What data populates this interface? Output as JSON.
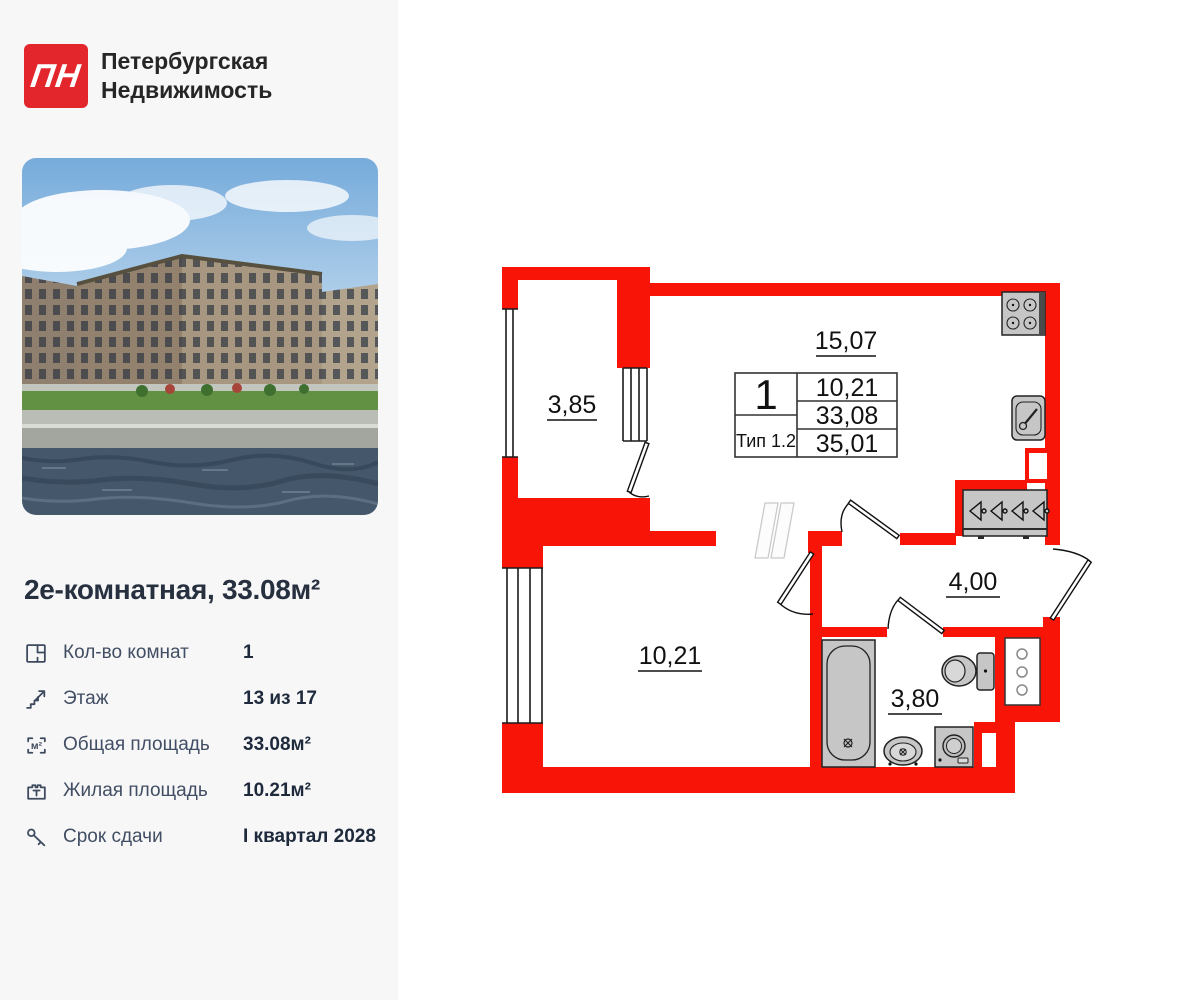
{
  "brand": {
    "logo": "ПН",
    "name_line1": "Петербургская",
    "name_line2": "Недвижимость"
  },
  "listing": {
    "title": "2е-комнатная, 33.08м²"
  },
  "details": [
    {
      "icon": "rooms-icon",
      "label": "Кол-во комнат",
      "value": "1"
    },
    {
      "icon": "floor-icon",
      "label": "Этаж",
      "value": "13 из 17"
    },
    {
      "icon": "total-area-icon",
      "label": "Общая площадь",
      "value": "33.08м²"
    },
    {
      "icon": "living-area-icon",
      "label": "Жилая площадь",
      "value": "10.21м²"
    },
    {
      "icon": "key-icon",
      "label": "Срок сдачи",
      "value": "I квартал 2028"
    }
  ],
  "floor_plan": {
    "labels": {
      "balcony": "3,85",
      "living_kitchen": "15,07",
      "bedroom": "10,21",
      "hallway": "4,00",
      "bathroom": "3,80"
    },
    "stamp": {
      "rooms": "1",
      "type": "Тип 1.2",
      "living_area": "10,21",
      "total_area": "33,08",
      "total_with_summer": "35,01"
    }
  },
  "colors": {
    "sidebar_bg": "#f7f7f8",
    "logo_red": "#e2262b",
    "title": "#27303f",
    "label": "#414e63",
    "value": "#1e2a3c",
    "wall": "#f81508",
    "fixture": "#c6c6c6"
  }
}
